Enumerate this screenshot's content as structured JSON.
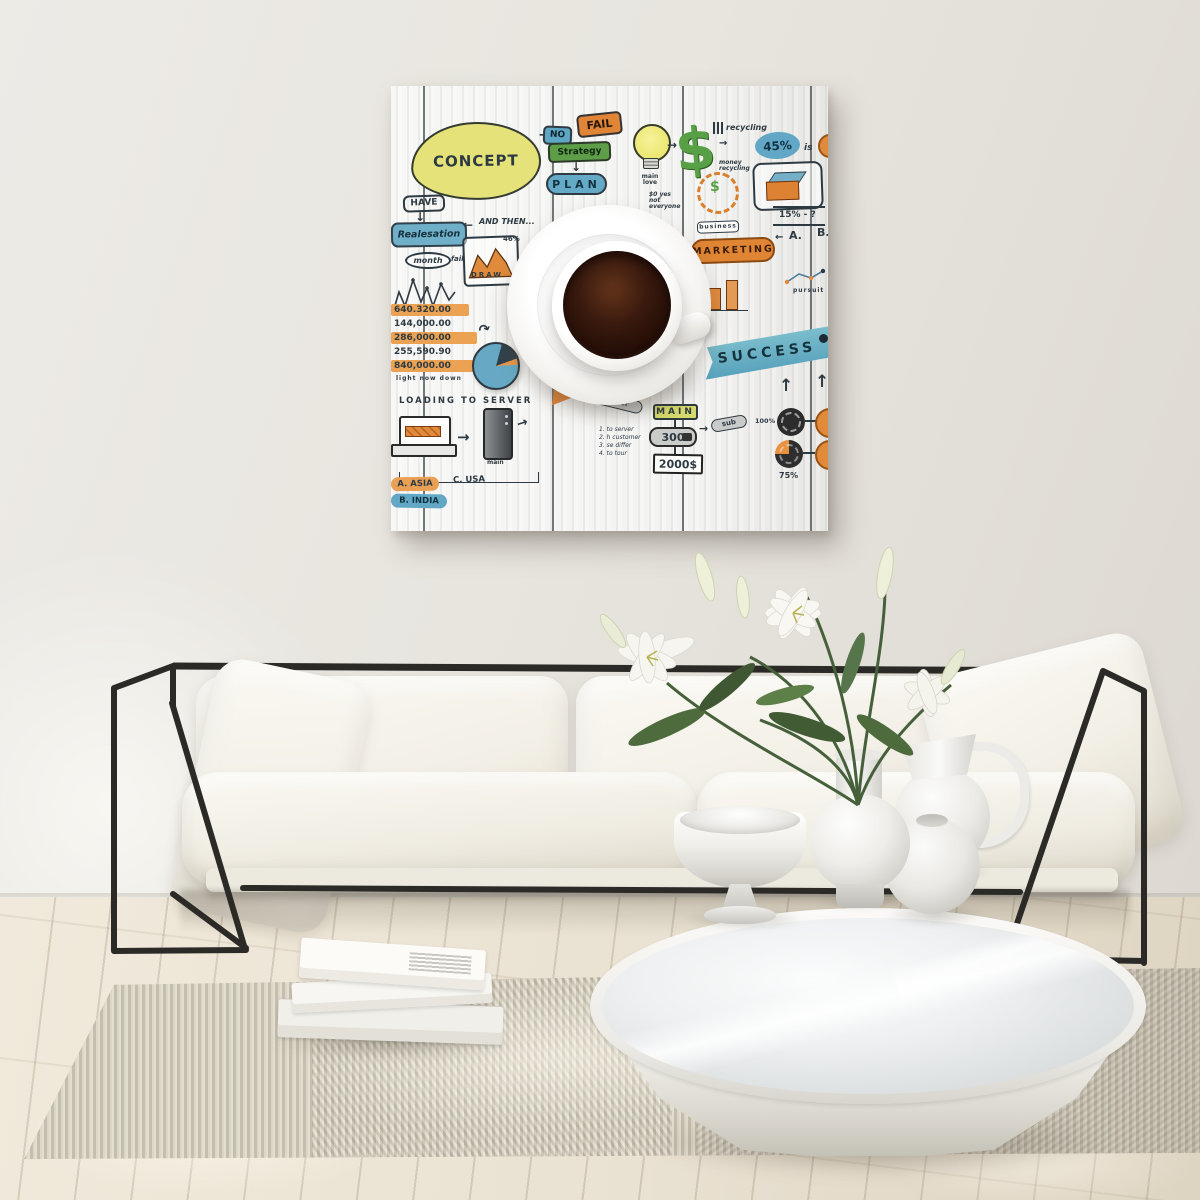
{
  "palette": {
    "wall": "#e7e4de",
    "floor": "#ece4d4",
    "rug": "#d8d1c0",
    "sofa_fabric": "#f3f0e8",
    "metal_frame": "#2c2a26",
    "canvas_ground": "#f4f4f2",
    "coffee": "#2a120a",
    "doodle_blue": "#62a8c6",
    "doodle_orange": "#e08a3c",
    "doodle_green": "#5f9e49",
    "doodle_yellow": "#e4e278",
    "ink": "#2e3a42"
  },
  "art": {
    "icons": {
      "arrow_right": "→",
      "arrow_left": "←",
      "arrow_down": "↓",
      "arrow_up": "↑",
      "curve_arrow": "↷"
    },
    "concept": "CONCEPT",
    "have": "HAVE",
    "realisation": "Realesation",
    "month": "month",
    "fail_note": "fail",
    "and_then": "AND THEN...",
    "pct46": "46%",
    "draw": "DRAW",
    "no": "NO",
    "fail": "FAIL",
    "strategy": "Strategy",
    "plan": "PLAN",
    "main_love": "main love",
    "not_everyone": "$0 yes not everyone",
    "dollar": "$",
    "recycling": "recycling",
    "pct45": "45%",
    "is": "is",
    "money_recycling": "money recycling",
    "pct15": "15% - ?",
    "label_a": "A.",
    "label_b": "B.",
    "business": "business",
    "marketing": "MARKETING",
    "pursuit": "pursuit",
    "success": "SUCCESS",
    "amounts": [
      "640.320.00",
      "144,000.00",
      "286,000.00",
      "255,590.90",
      "840,000.00"
    ],
    "amounts_note": "light now down",
    "loading": "LOADING TO SERVER",
    "server_label": "main",
    "asia": "A. ASIA",
    "usa": "C. USA",
    "india": "B. INDIA",
    "other": "other",
    "notes": [
      "1. to server",
      "2. h customer",
      "3. se differ",
      "4. to tour"
    ],
    "main": "MAIN",
    "n300": "300",
    "sub": "sub",
    "price": "2000$",
    "pct100": "100%",
    "pct75": "75%"
  }
}
